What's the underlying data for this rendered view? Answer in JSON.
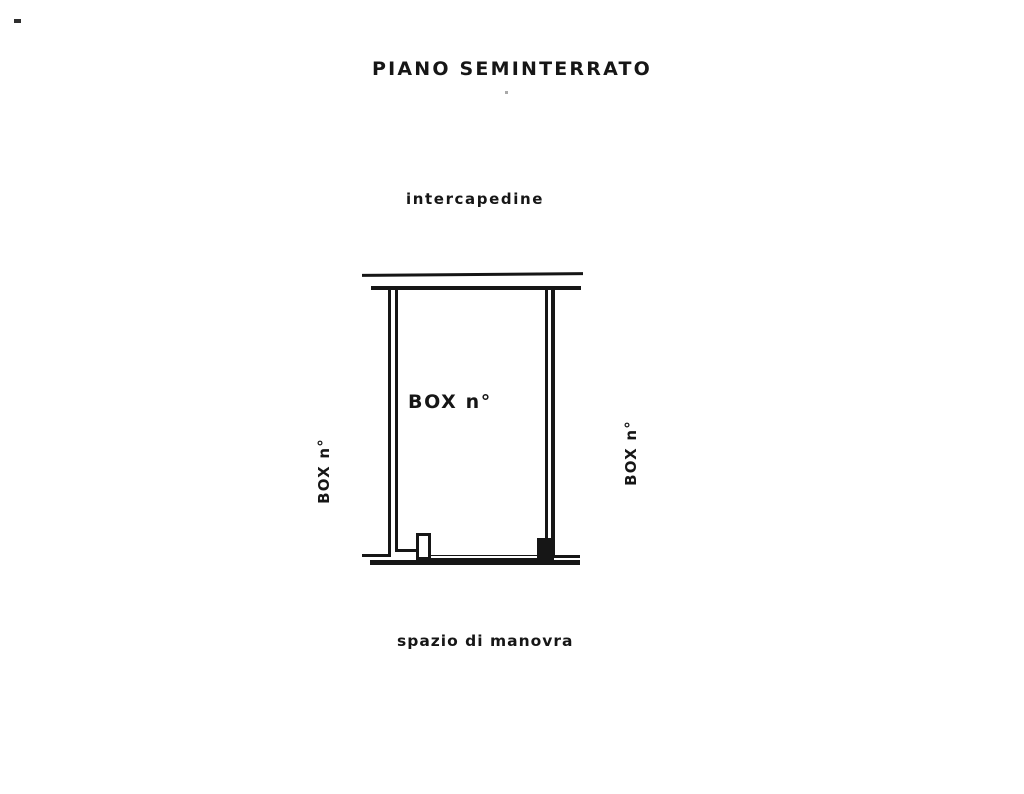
{
  "page": {
    "background": "#ffffff",
    "ink_color": "#161616"
  },
  "floorplan": {
    "title": "PIANO SEMINTERRATO",
    "labels": {
      "top_area": "intercapedine",
      "box_center": "BOX n°",
      "box_left": "BOX n°",
      "box_right": "BOX n°",
      "bottom_area": "spazio di manovra"
    }
  }
}
